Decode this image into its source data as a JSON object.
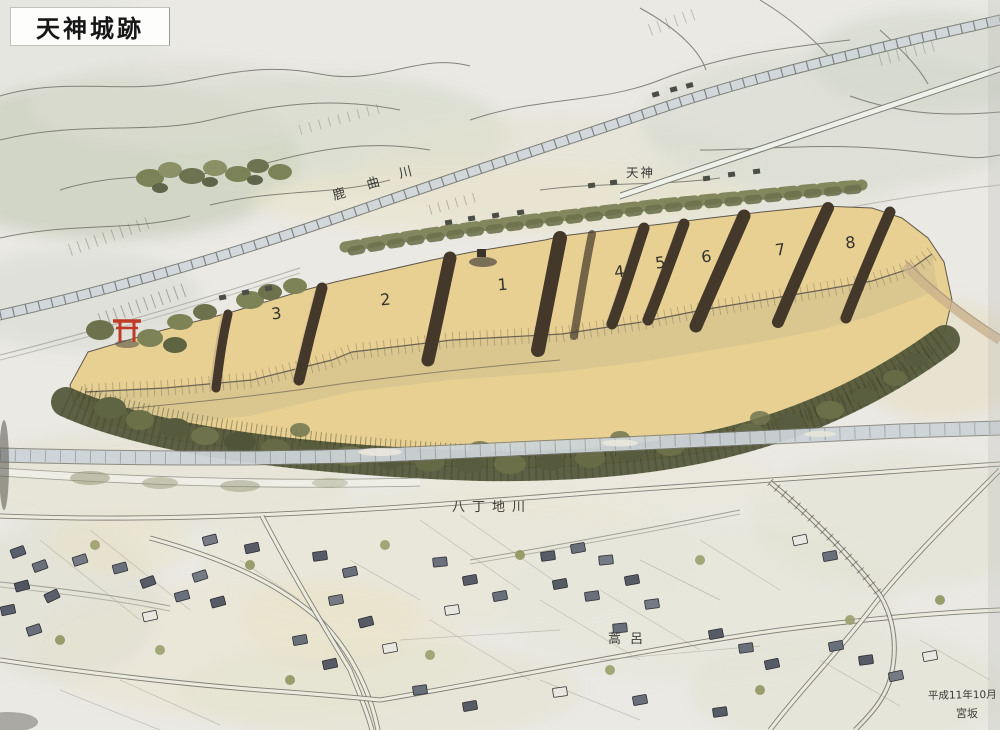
{
  "title": "天神城跡",
  "labels": {
    "kakuma_river": [
      "鹿",
      "曲",
      "川"
    ],
    "tenjin": "天神",
    "hatchoji_river": "八丁地川",
    "village": "蒿呂",
    "date": "平成11年10月",
    "signature": "宮坂"
  },
  "plateau_numbers": [
    "1",
    "2",
    "3",
    "4",
    "5",
    "6",
    "7",
    "8"
  ],
  "icons": {
    "torii": "torii-gate"
  },
  "palette": {
    "paper": "#eae9e4",
    "plateau_yellow": "#e8d092",
    "trench_brown": "#43382a",
    "tree_green": "#555a3c",
    "river_blue": "#ccd3d7",
    "torii_red": "#c03a28",
    "ink": "#3b3b36",
    "roof_gray": "#5a5f6e"
  }
}
